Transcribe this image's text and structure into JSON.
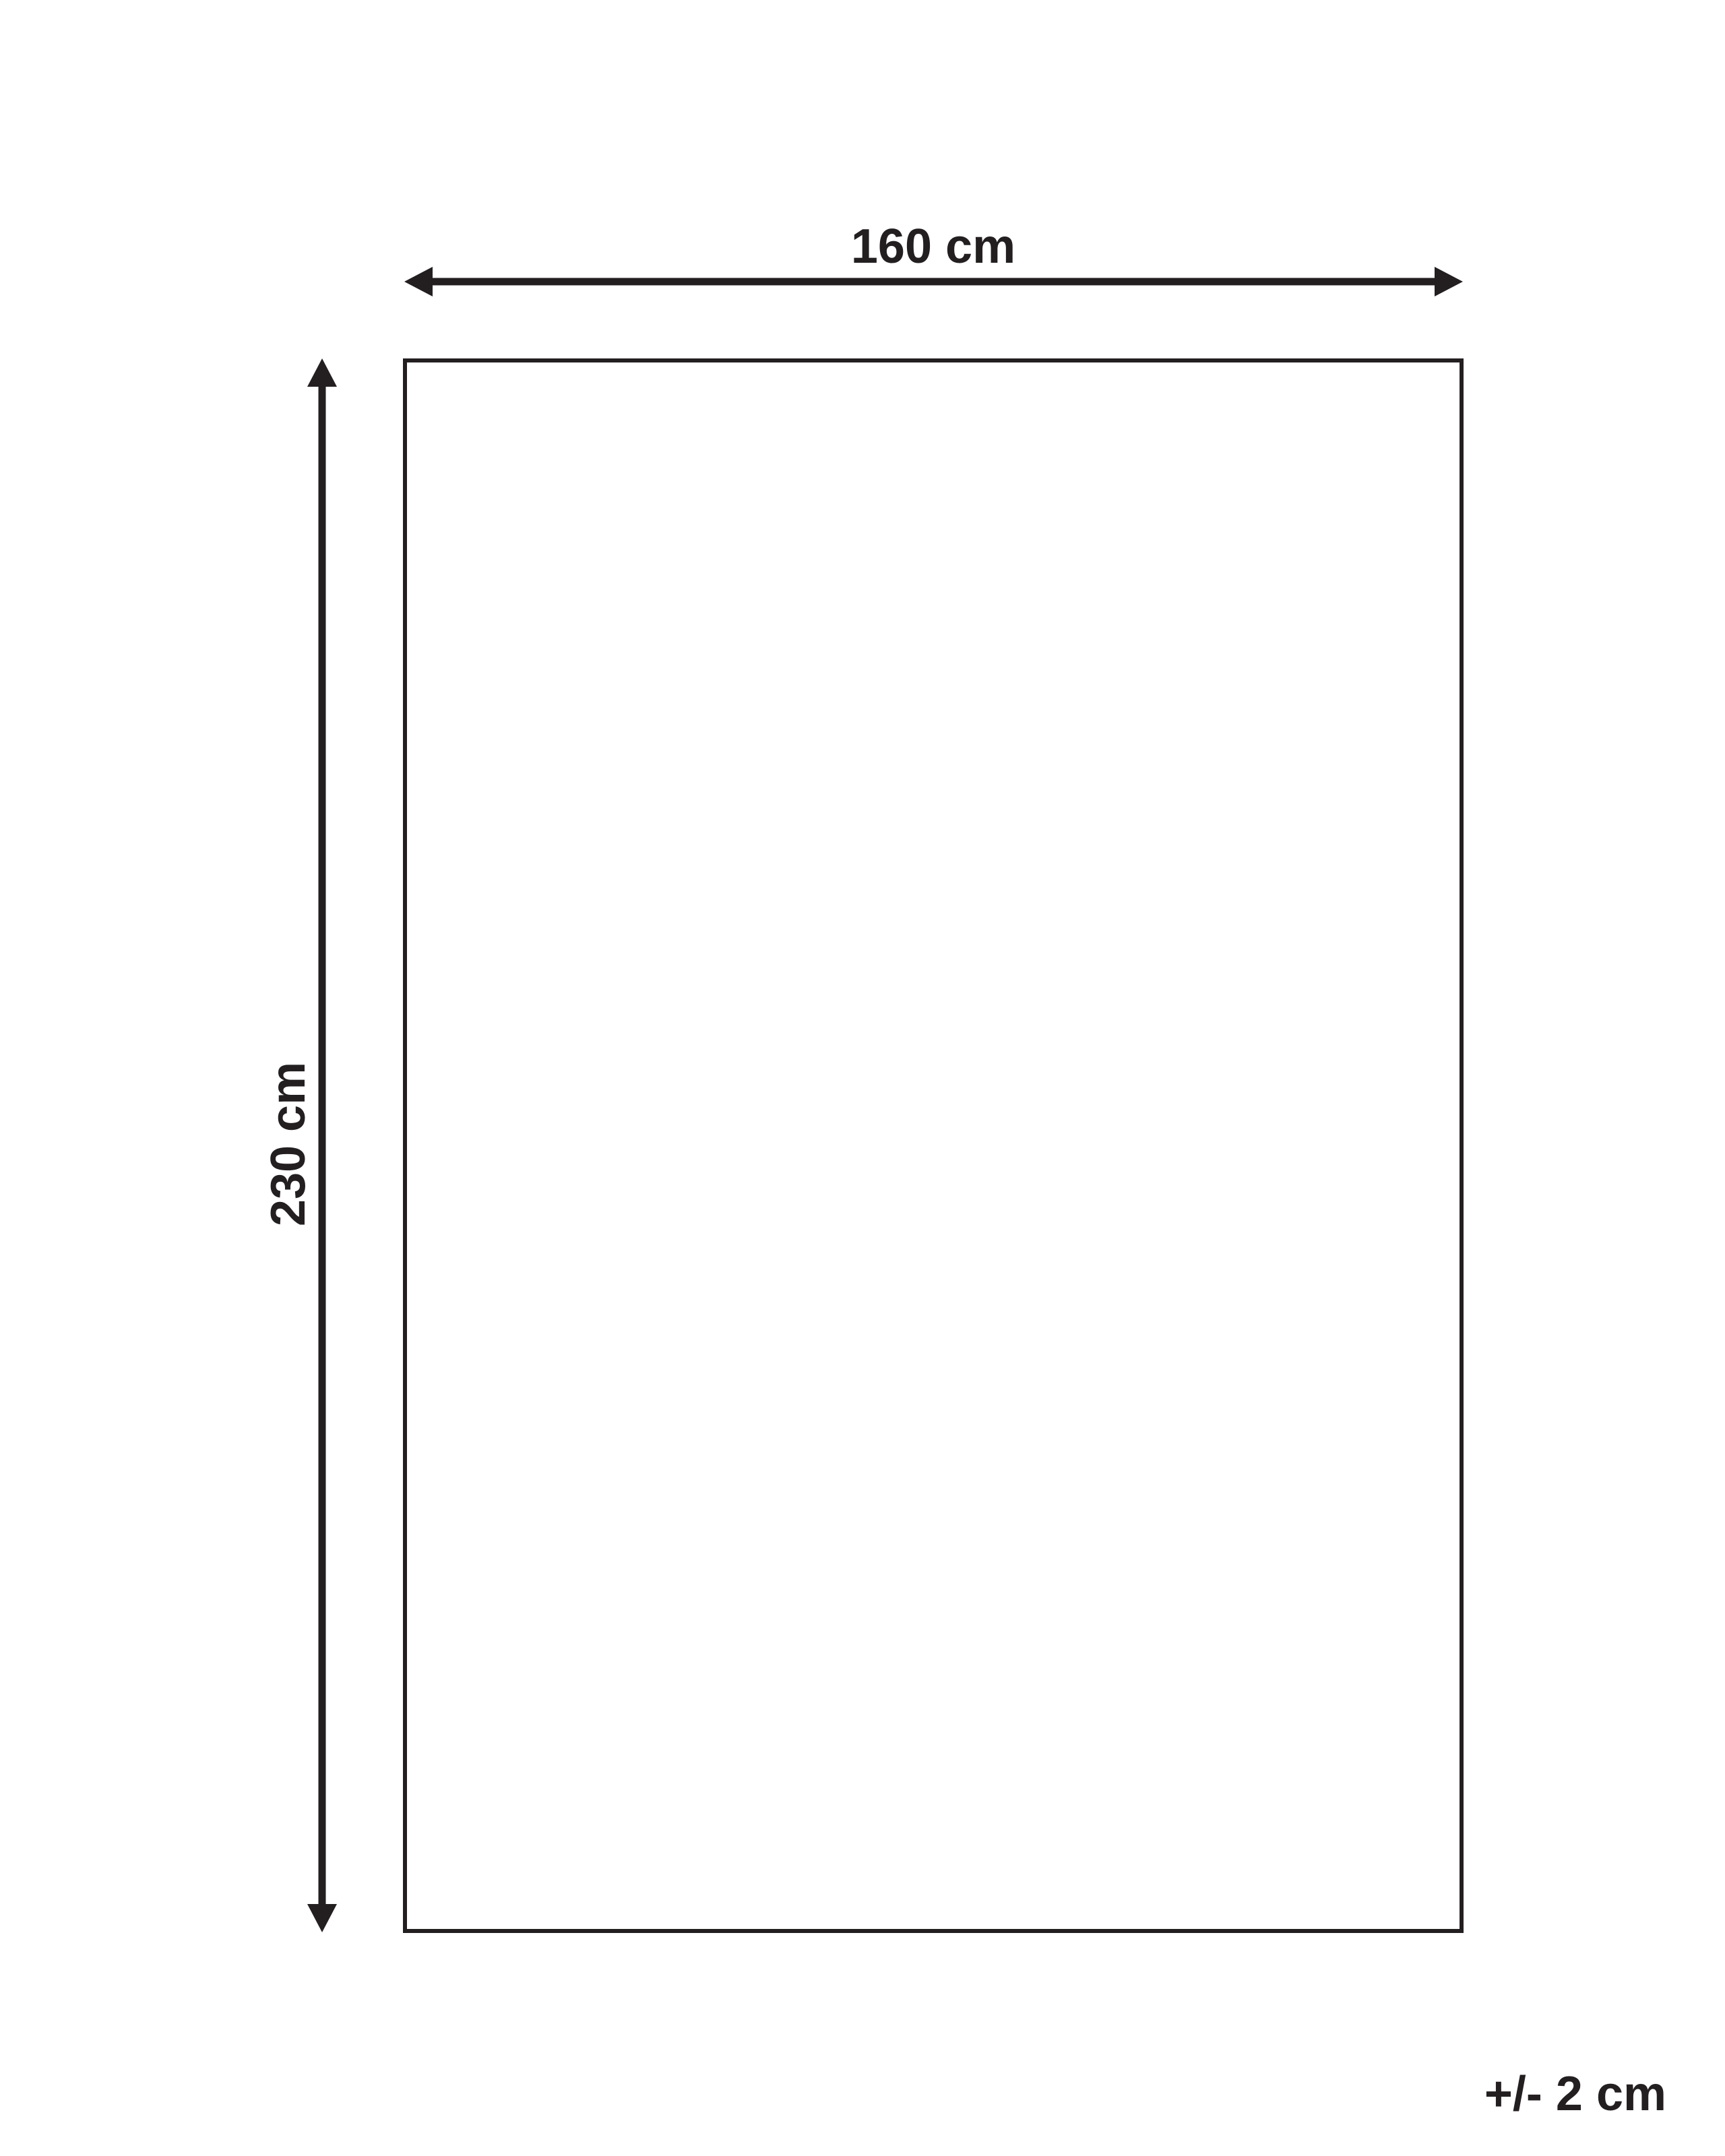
{
  "diagram": {
    "type": "product-dimension-diagram",
    "width_label": "160 cm",
    "height_label": "230 cm",
    "tolerance_label": "+/- 2 cm",
    "line_color": "#231f20",
    "background_color": "#ffffff"
  }
}
